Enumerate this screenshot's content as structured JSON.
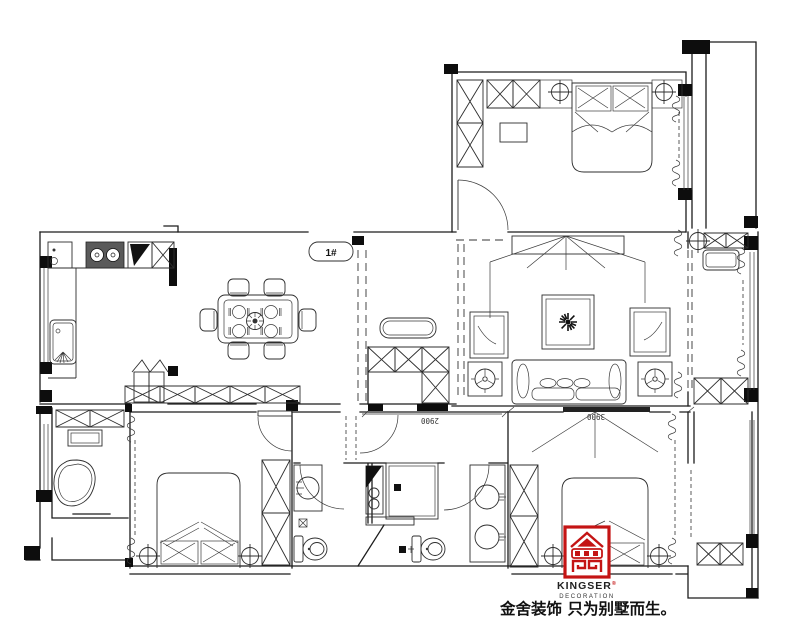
{
  "plan": {
    "entry_label": "1#",
    "dim_corridor": "2900",
    "dim_bedroom": "3900"
  },
  "branding": {
    "logo_name": "KINGSER",
    "logo_mark": "®",
    "logo_sub": "DECORATION",
    "slogan": "金舍装饰 只为别墅而生。",
    "logo_color": "#c41414",
    "ink_color": "#1c1c1c"
  },
  "symbols": {
    "ceiling_light": "circle-cross",
    "chandelier": "starburst",
    "downlight_fan": "circle-blades",
    "curtain": "coil",
    "wardrobe": "x-hatch-box"
  }
}
